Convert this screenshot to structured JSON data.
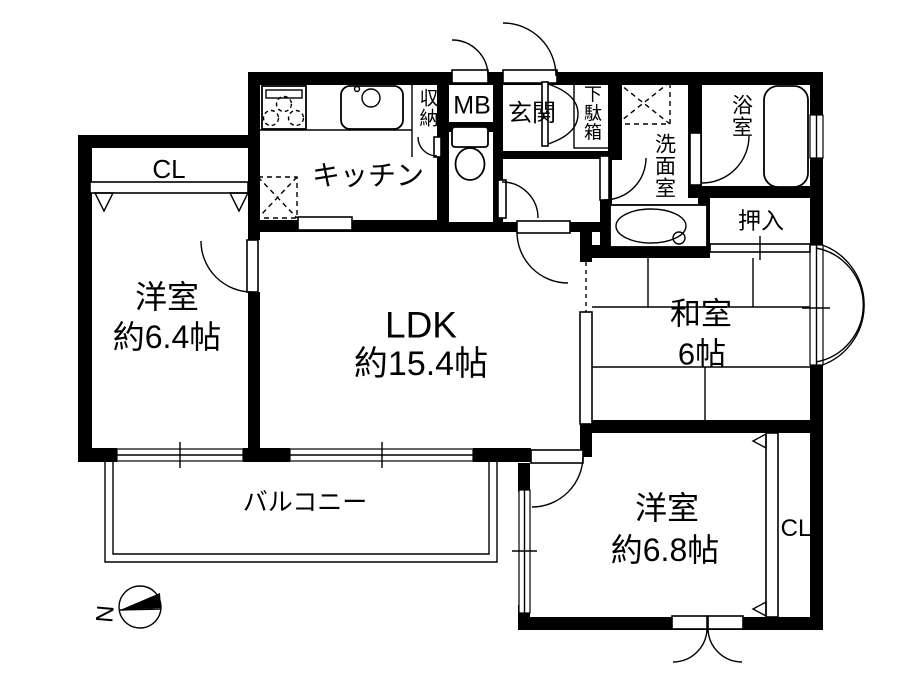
{
  "plan": {
    "rooms": {
      "closet_left": "CL",
      "western1": {
        "name": "洋室",
        "size": "約6.4帖"
      },
      "kitchen": "キッチン",
      "storage": "収納",
      "meter_box": "MB",
      "entrance": "玄関",
      "shoe_box": "下駄箱",
      "washroom": "洗面室",
      "bathroom": "浴室",
      "oshiire": "押入",
      "ldk": {
        "name": "LDK",
        "size": "約15.4帖"
      },
      "japanese": {
        "name": "和室",
        "size": "6帖"
      },
      "balcony": "バルコニー",
      "western2": {
        "name": "洋室",
        "size": "約6.8帖"
      },
      "closet_right": "CL"
    },
    "compass": {
      "north_label": "N"
    },
    "colors": {
      "line": "#000000",
      "background": "#ffffff"
    }
  }
}
